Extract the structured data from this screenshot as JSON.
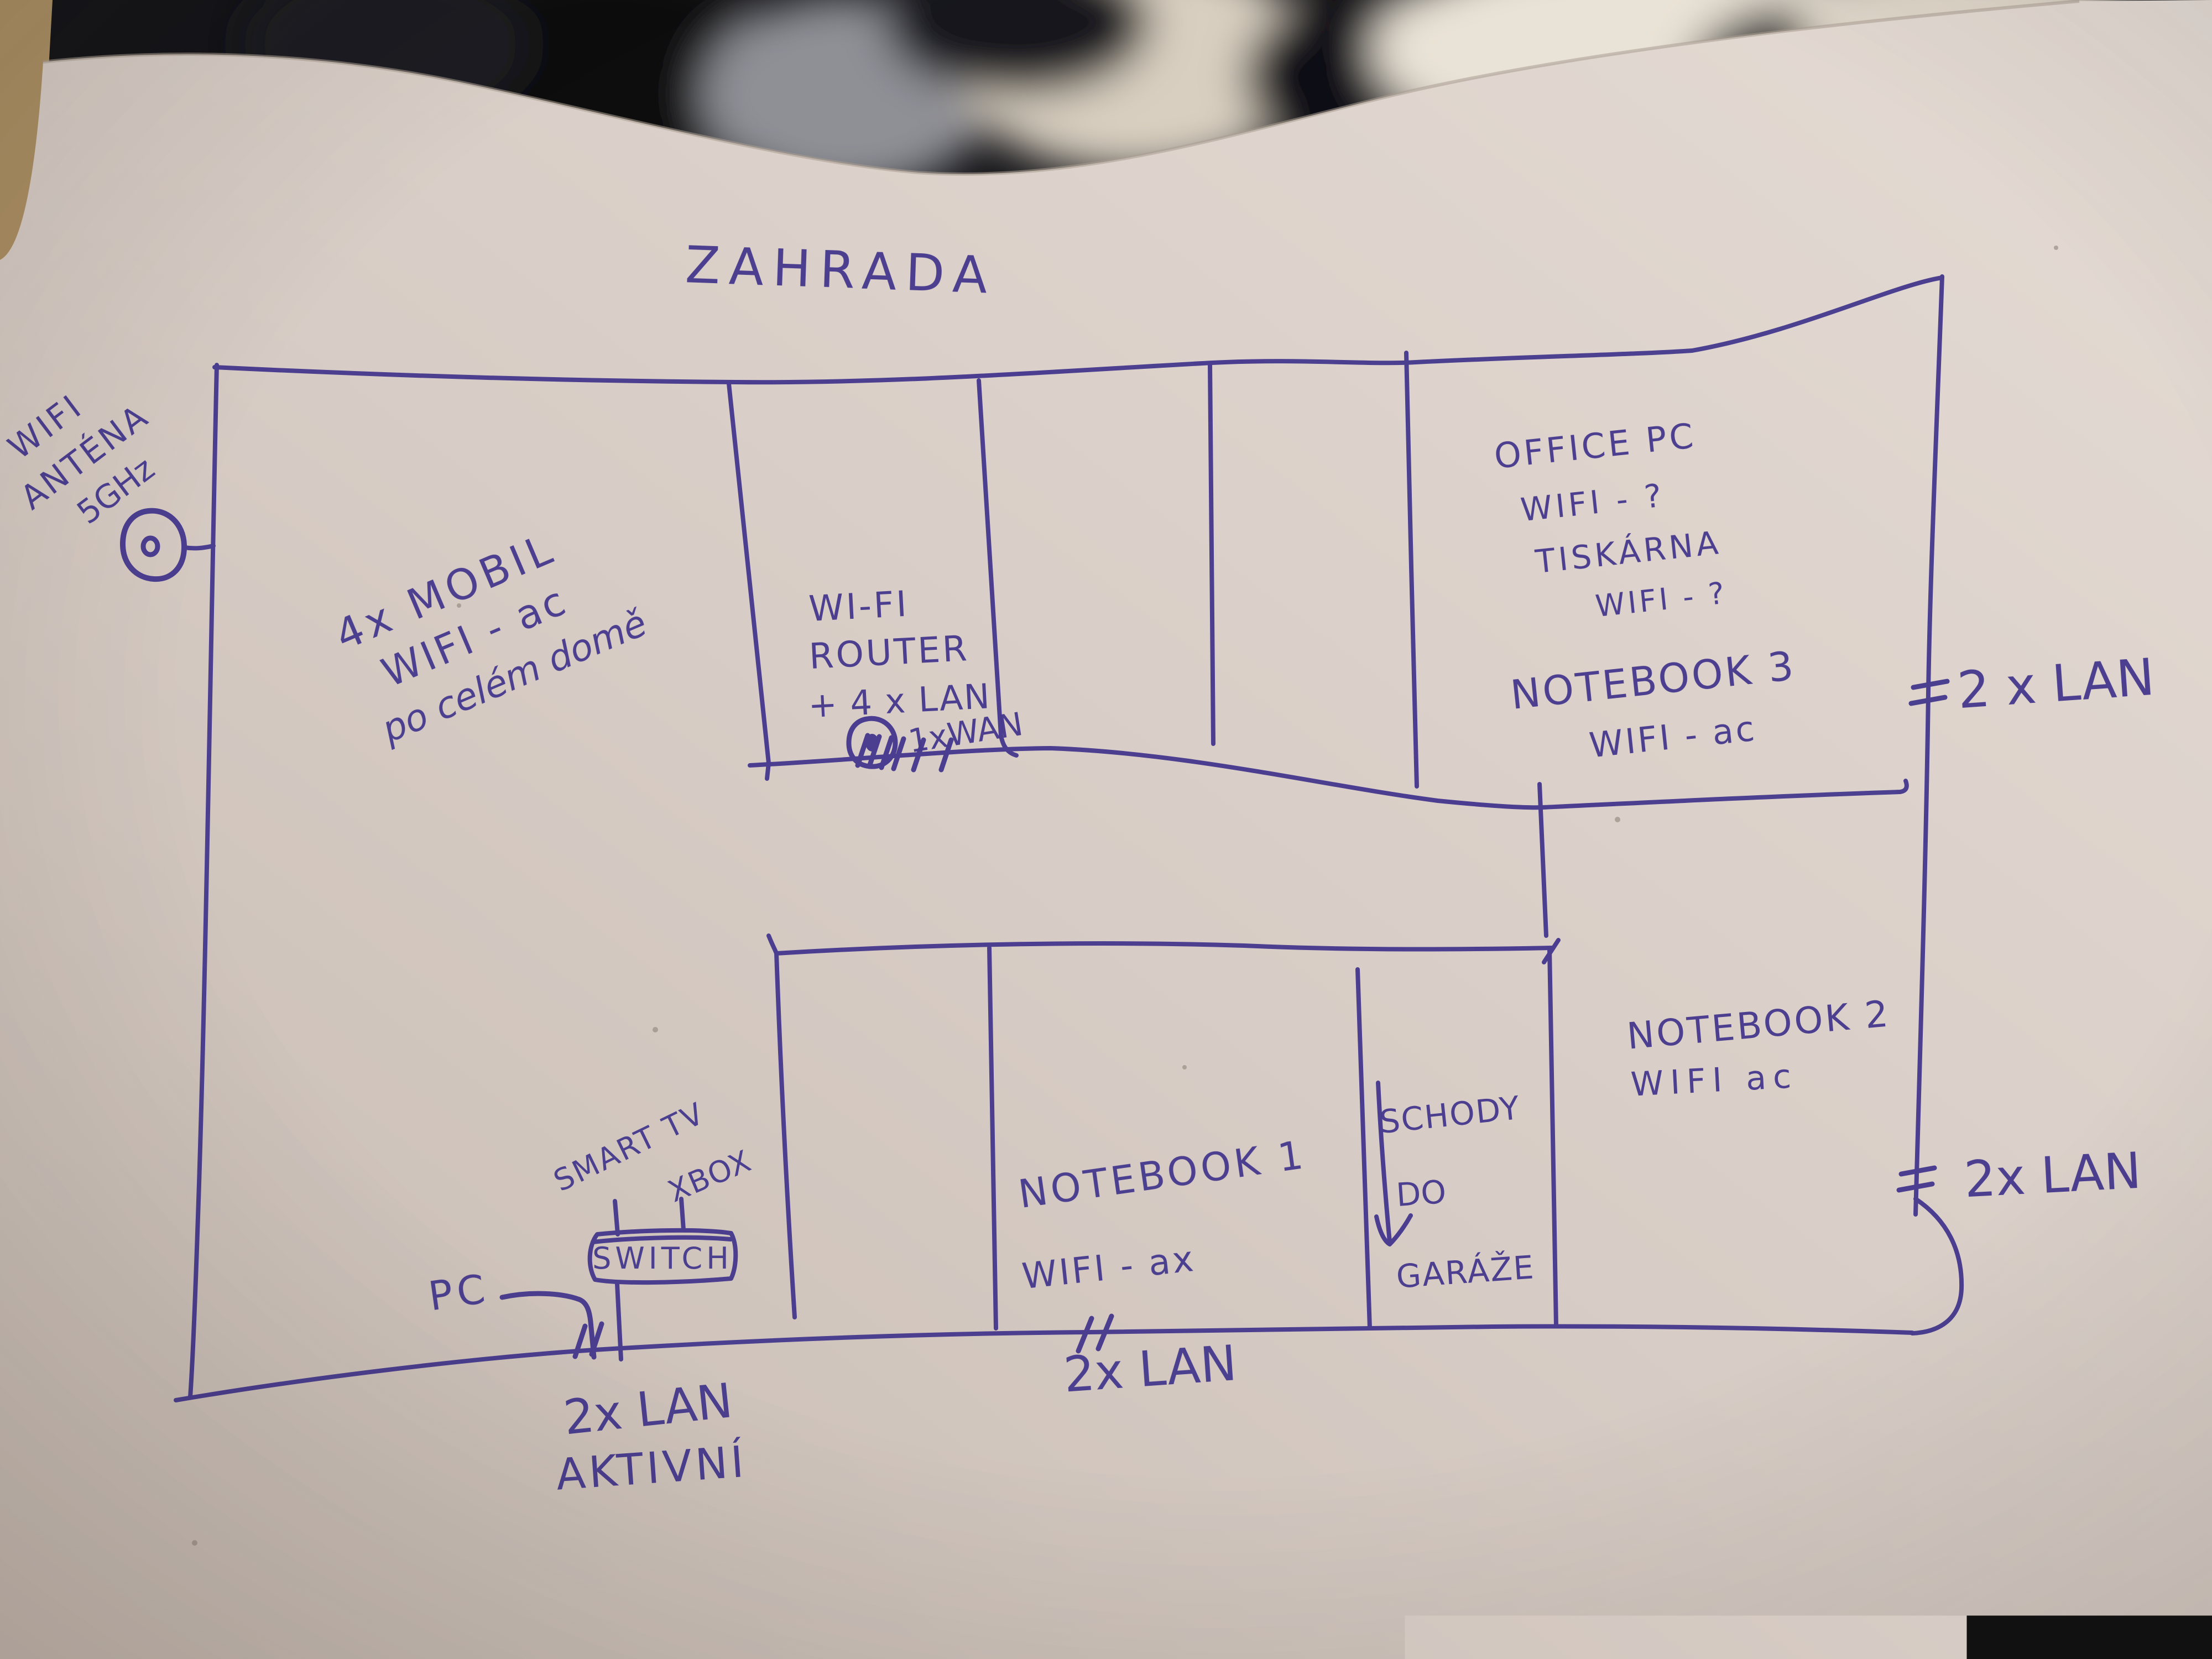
{
  "photo": {
    "description": "hand-drawn home network floor plan, blue marker on paper",
    "ink_color": "#46398e",
    "paper_color": "#d8cec7",
    "paper_light": "#e3dad3",
    "paper_dark": "#c5b9b0",
    "blanket_dark": "#141418",
    "blanket_fur_white": "#e9e2d6",
    "blanket_fur_cream": "#d8cfc0",
    "blanket_gray": "#8f9096",
    "table_tan": "#ab8f63"
  },
  "labels": {
    "garden": "ZAHRADA",
    "antenna_line1": "WIFI",
    "antenna_line2": "ANTÉNA",
    "antenna_line3": "5GHz",
    "living_line1": "4x MOBIL",
    "living_line2": "WIFI - ac",
    "living_line3": "po celém domě",
    "router_line1": "WI-FI",
    "router_line2": "ROUTER",
    "router_line3": "+ 4 x LAN",
    "router_wan": "1xWAN",
    "office_line1": "OFFICE PC",
    "office_line2": "WIFI - ?",
    "office_line3": "TISKÁRNA",
    "office_line4": "WIFI - ?",
    "office_line5": "NOTEBOOK 3",
    "office_line6": "WIFI - ac",
    "lan_top_right": "2 x LAN",
    "notebook2_line1": "NOTEBOOK 2",
    "notebook2_line2": "WIFI  ac",
    "lan_mid_right": "2x LAN",
    "notebook1_line1": "NOTEBOOK 1",
    "notebook1_line2": "WIFI - ax",
    "stairs_line1": "SCHODY",
    "stairs_line2": "DO",
    "stairs_line3": "GARÁŽE",
    "smart_tv": "SMART TV",
    "xbox": "XBOX",
    "switch": "SWITCH",
    "pc": "PC",
    "lan_bottom_left_line1": "2x LAN",
    "lan_bottom_left_line2": "AKTIVNÍ",
    "lan_bottom_mid": "2x LAN"
  }
}
